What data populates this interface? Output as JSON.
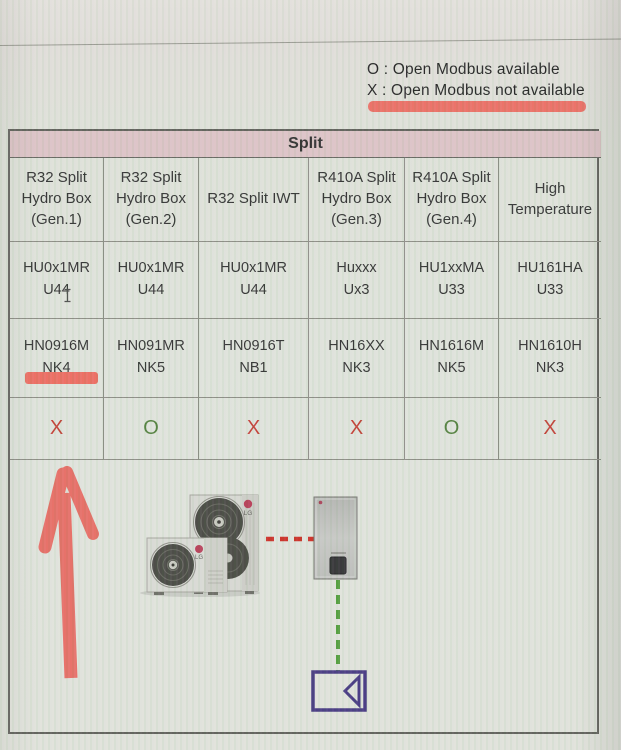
{
  "legend": {
    "available": "O : Open Modbus available",
    "not_available": "X : Open Modbus not available"
  },
  "table": {
    "group_header": "Split",
    "columns": [
      {
        "header": "R32 Split\nHydro Box\n(Gen.1)",
        "outdoor_unit": "HU0x1MR\nU44",
        "hydro_box": "HN0916M\nNK4",
        "open_modbus": "X"
      },
      {
        "header": "R32 Split\nHydro Box\n(Gen.2)",
        "outdoor_unit": "HU0x1MR\nU44",
        "hydro_box": "HN091MR\nNK5",
        "open_modbus": "O"
      },
      {
        "header": "R32 Split IWT",
        "outdoor_unit": "HU0x1MR\nU44",
        "hydro_box": "HN0916T\nNB1",
        "open_modbus": "X"
      },
      {
        "header": "R410A Split\nHydro Box\n(Gen.3)",
        "outdoor_unit": "Huxxx\nUx3",
        "hydro_box": "HN16XX\nNK3",
        "open_modbus": "X"
      },
      {
        "header": "R410A Split\nHydro Box\n(Gen.4)",
        "outdoor_unit": "HU1xxMA\nU33",
        "hydro_box": "HN1616M\nNK5",
        "open_modbus": "O"
      },
      {
        "header": "High\nTemperature",
        "outdoor_unit": "HU161HA\nU33",
        "hydro_box": "HN1610H\nNK3",
        "open_modbus": "X"
      }
    ]
  },
  "diagram": {
    "lg_label": "LG"
  },
  "colors": {
    "marker_red": "#ee5348",
    "x_red": "#c23b32",
    "o_green": "#4f7d39",
    "header_pink": "#dcc2c5",
    "dashed_red": "#cc2a22",
    "dashed_green": "#4f9c38",
    "symbol_purple": "#43357f"
  }
}
